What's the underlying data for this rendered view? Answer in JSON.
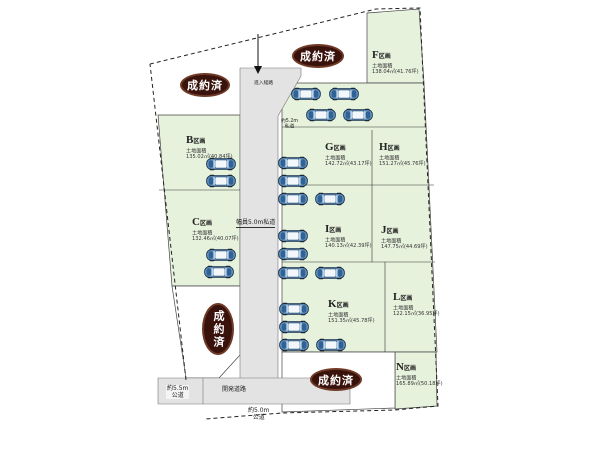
{
  "sold_label": "成約済",
  "plots": {
    "B": {
      "letter": "B",
      "suffix": "区画",
      "area_label": "土地面積",
      "area": "135.02㎡(40.84坪)"
    },
    "C": {
      "letter": "C",
      "suffix": "区画",
      "area_label": "土地面積",
      "area": "132.46㎡(40.07坪)"
    },
    "F": {
      "letter": "F",
      "suffix": "区画",
      "area_label": "土地面積",
      "area": "138.04㎡(41.76坪)"
    },
    "G": {
      "letter": "G",
      "suffix": "区画",
      "area_label": "土地面積",
      "area": "142.72㎡(43.17坪)"
    },
    "H": {
      "letter": "H",
      "suffix": "区画",
      "area_label": "土地面積",
      "area": "151.27㎡(45.76坪)"
    },
    "I": {
      "letter": "I",
      "suffix": "区画",
      "area_label": "土地面積",
      "area": "140.13㎡(42.39坪)"
    },
    "J": {
      "letter": "J",
      "suffix": "区画",
      "area_label": "土地面積",
      "area": "147.75㎡(44.69坪)"
    },
    "K": {
      "letter": "K",
      "suffix": "区画",
      "area_label": "土地面積",
      "area": "151.35㎡(45.78坪)"
    },
    "L": {
      "letter": "L",
      "suffix": "区画",
      "area_label": "土地面積",
      "area": "122.15㎡(36.95坪)"
    },
    "N": {
      "letter": "N",
      "suffix": "区画",
      "area_label": "土地面積",
      "area": "165.89㎡(50.18坪)"
    }
  },
  "roads": {
    "entrance": "進入経路",
    "width_note_line1": "約5.2m",
    "width_note_line2": "私道",
    "center": "幅員5.0m私道",
    "development": "開発道路",
    "west_line1": "約5.5m",
    "west_line2": "公道",
    "south_line1": "約5.0m",
    "south_line2": "公道"
  },
  "colors": {
    "plot_green": "#e7f2dd",
    "road_gray": "#e3e3e3",
    "sold_brown": "#3a120c"
  },
  "cars": [
    {
      "x": 206,
      "y": 157
    },
    {
      "x": 206,
      "y": 174
    },
    {
      "x": 206,
      "y": 248
    },
    {
      "x": 204,
      "y": 265
    },
    {
      "x": 291,
      "y": 87
    },
    {
      "x": 329,
      "y": 87
    },
    {
      "x": 306,
      "y": 108
    },
    {
      "x": 343,
      "y": 108
    },
    {
      "x": 278,
      "y": 156
    },
    {
      "x": 278,
      "y": 174
    },
    {
      "x": 278,
      "y": 192
    },
    {
      "x": 315,
      "y": 192
    },
    {
      "x": 278,
      "y": 229
    },
    {
      "x": 278,
      "y": 247
    },
    {
      "x": 278,
      "y": 266
    },
    {
      "x": 315,
      "y": 266
    },
    {
      "x": 279,
      "y": 302
    },
    {
      "x": 279,
      "y": 320
    },
    {
      "x": 279,
      "y": 338
    },
    {
      "x": 316,
      "y": 338
    }
  ]
}
